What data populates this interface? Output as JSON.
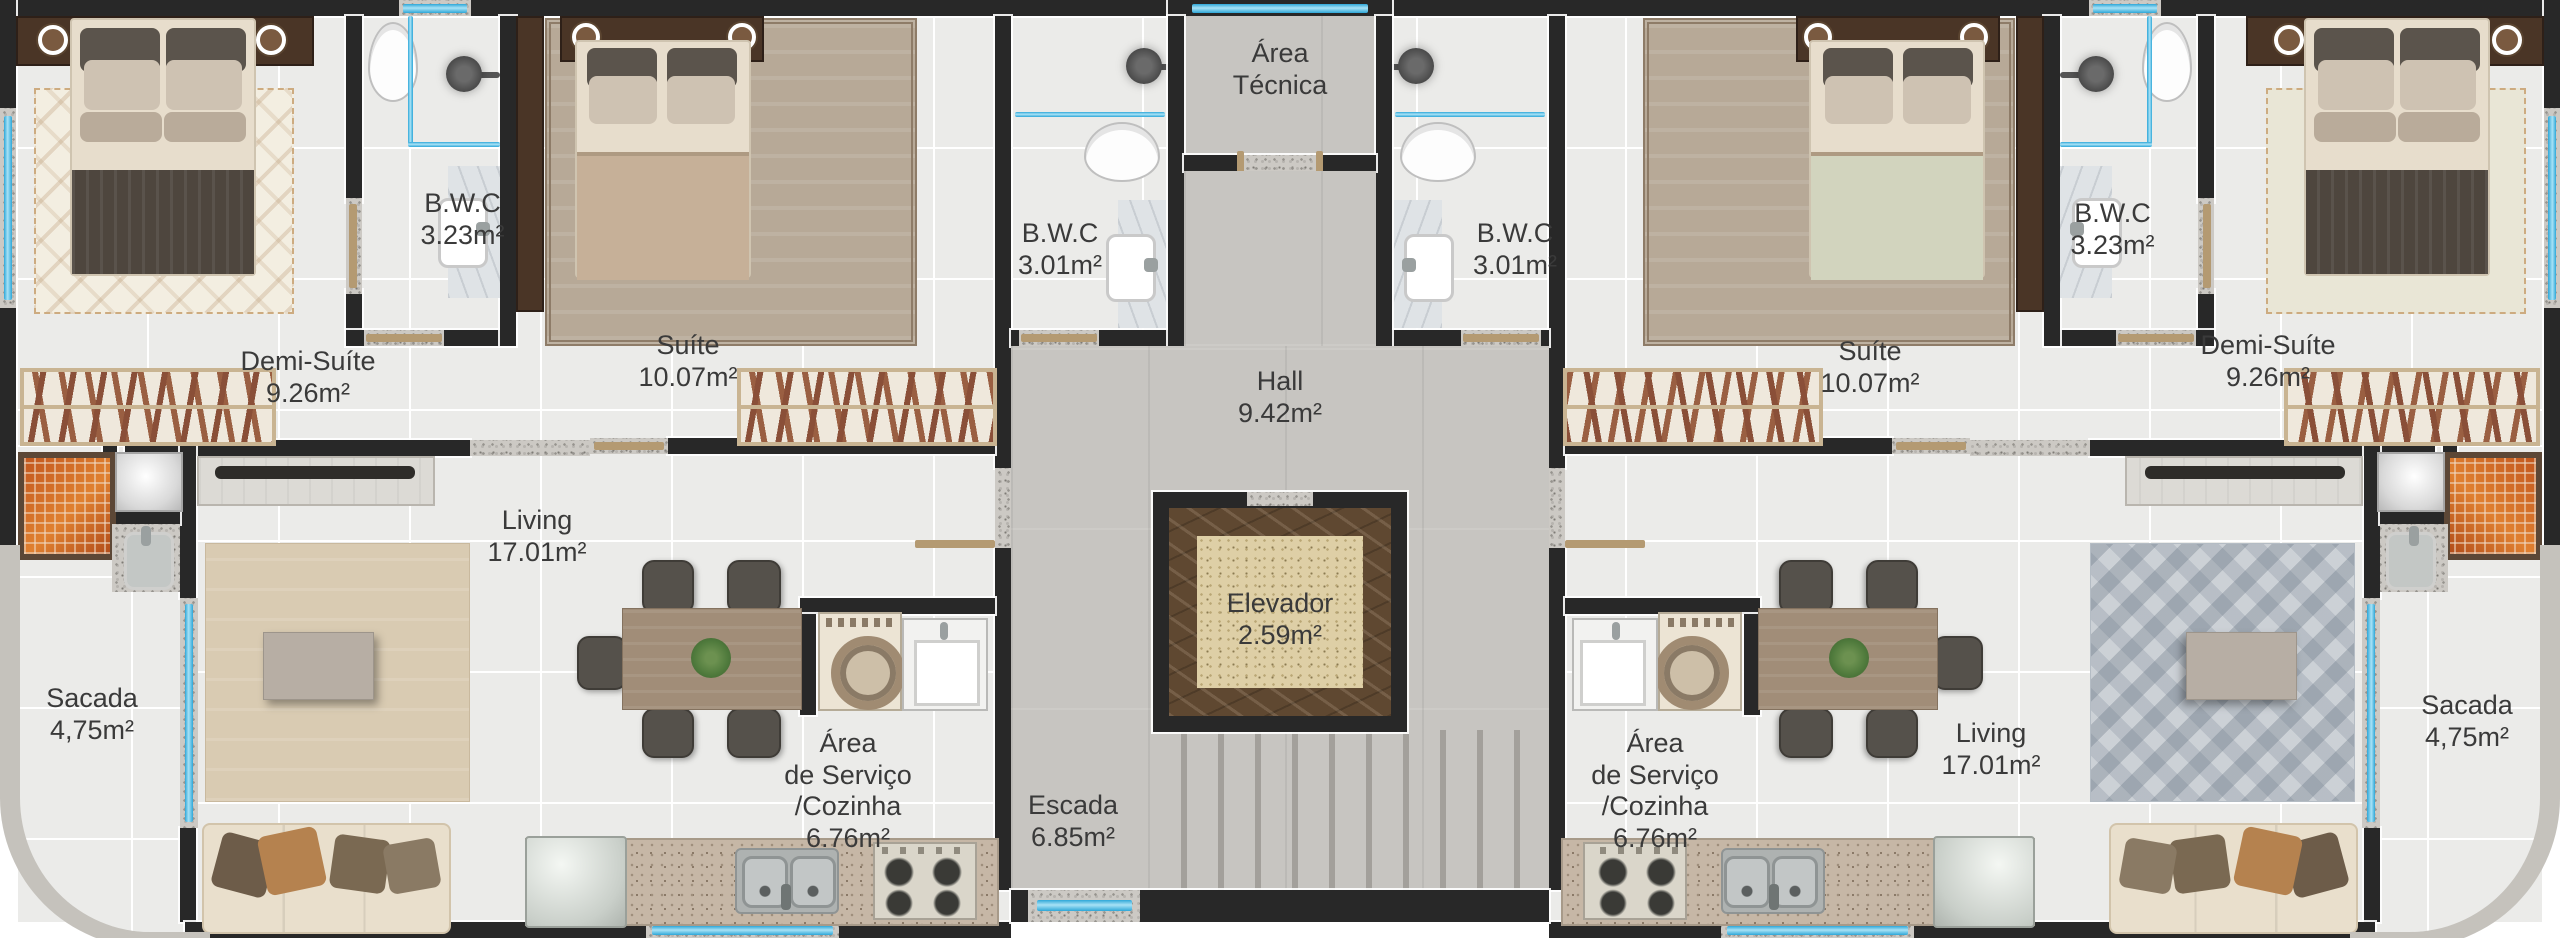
{
  "plan": {
    "core": {
      "area_tecnica": {
        "name": "Área Técnica"
      },
      "hall": {
        "name": "Hall",
        "area": "9.42m²"
      },
      "elevador": {
        "name": "Elevador",
        "area": "2.59m²"
      },
      "escada": {
        "name": "Escada",
        "area": "6.85m²"
      }
    },
    "apartment": {
      "demi_suite": {
        "name": "Demi-Suíte",
        "area": "9.26m²"
      },
      "bwc_demi": {
        "name": "B.W.C",
        "area": "3.23m²"
      },
      "suite": {
        "name": "Suíte",
        "area": "10.07m²"
      },
      "bwc_suite": {
        "name": "B.W.C",
        "area": "3.01m²"
      },
      "living": {
        "name": "Living",
        "area": "17.01m²"
      },
      "sacada": {
        "name": "Sacada",
        "area": "4,75m²"
      },
      "servico": {
        "line1": "Área",
        "line2": "de Serviço",
        "line3": "/Cozinha",
        "area": "6.76m²"
      }
    },
    "colors": {
      "wall": "#282828",
      "window_glass": "#2ea7d8",
      "floor_tile": "#ebebe9",
      "concrete": "#c7c5c1",
      "elevator_marble": "#5f4831",
      "elevator_core": "#decfa6",
      "door": "#b49a72"
    }
  }
}
